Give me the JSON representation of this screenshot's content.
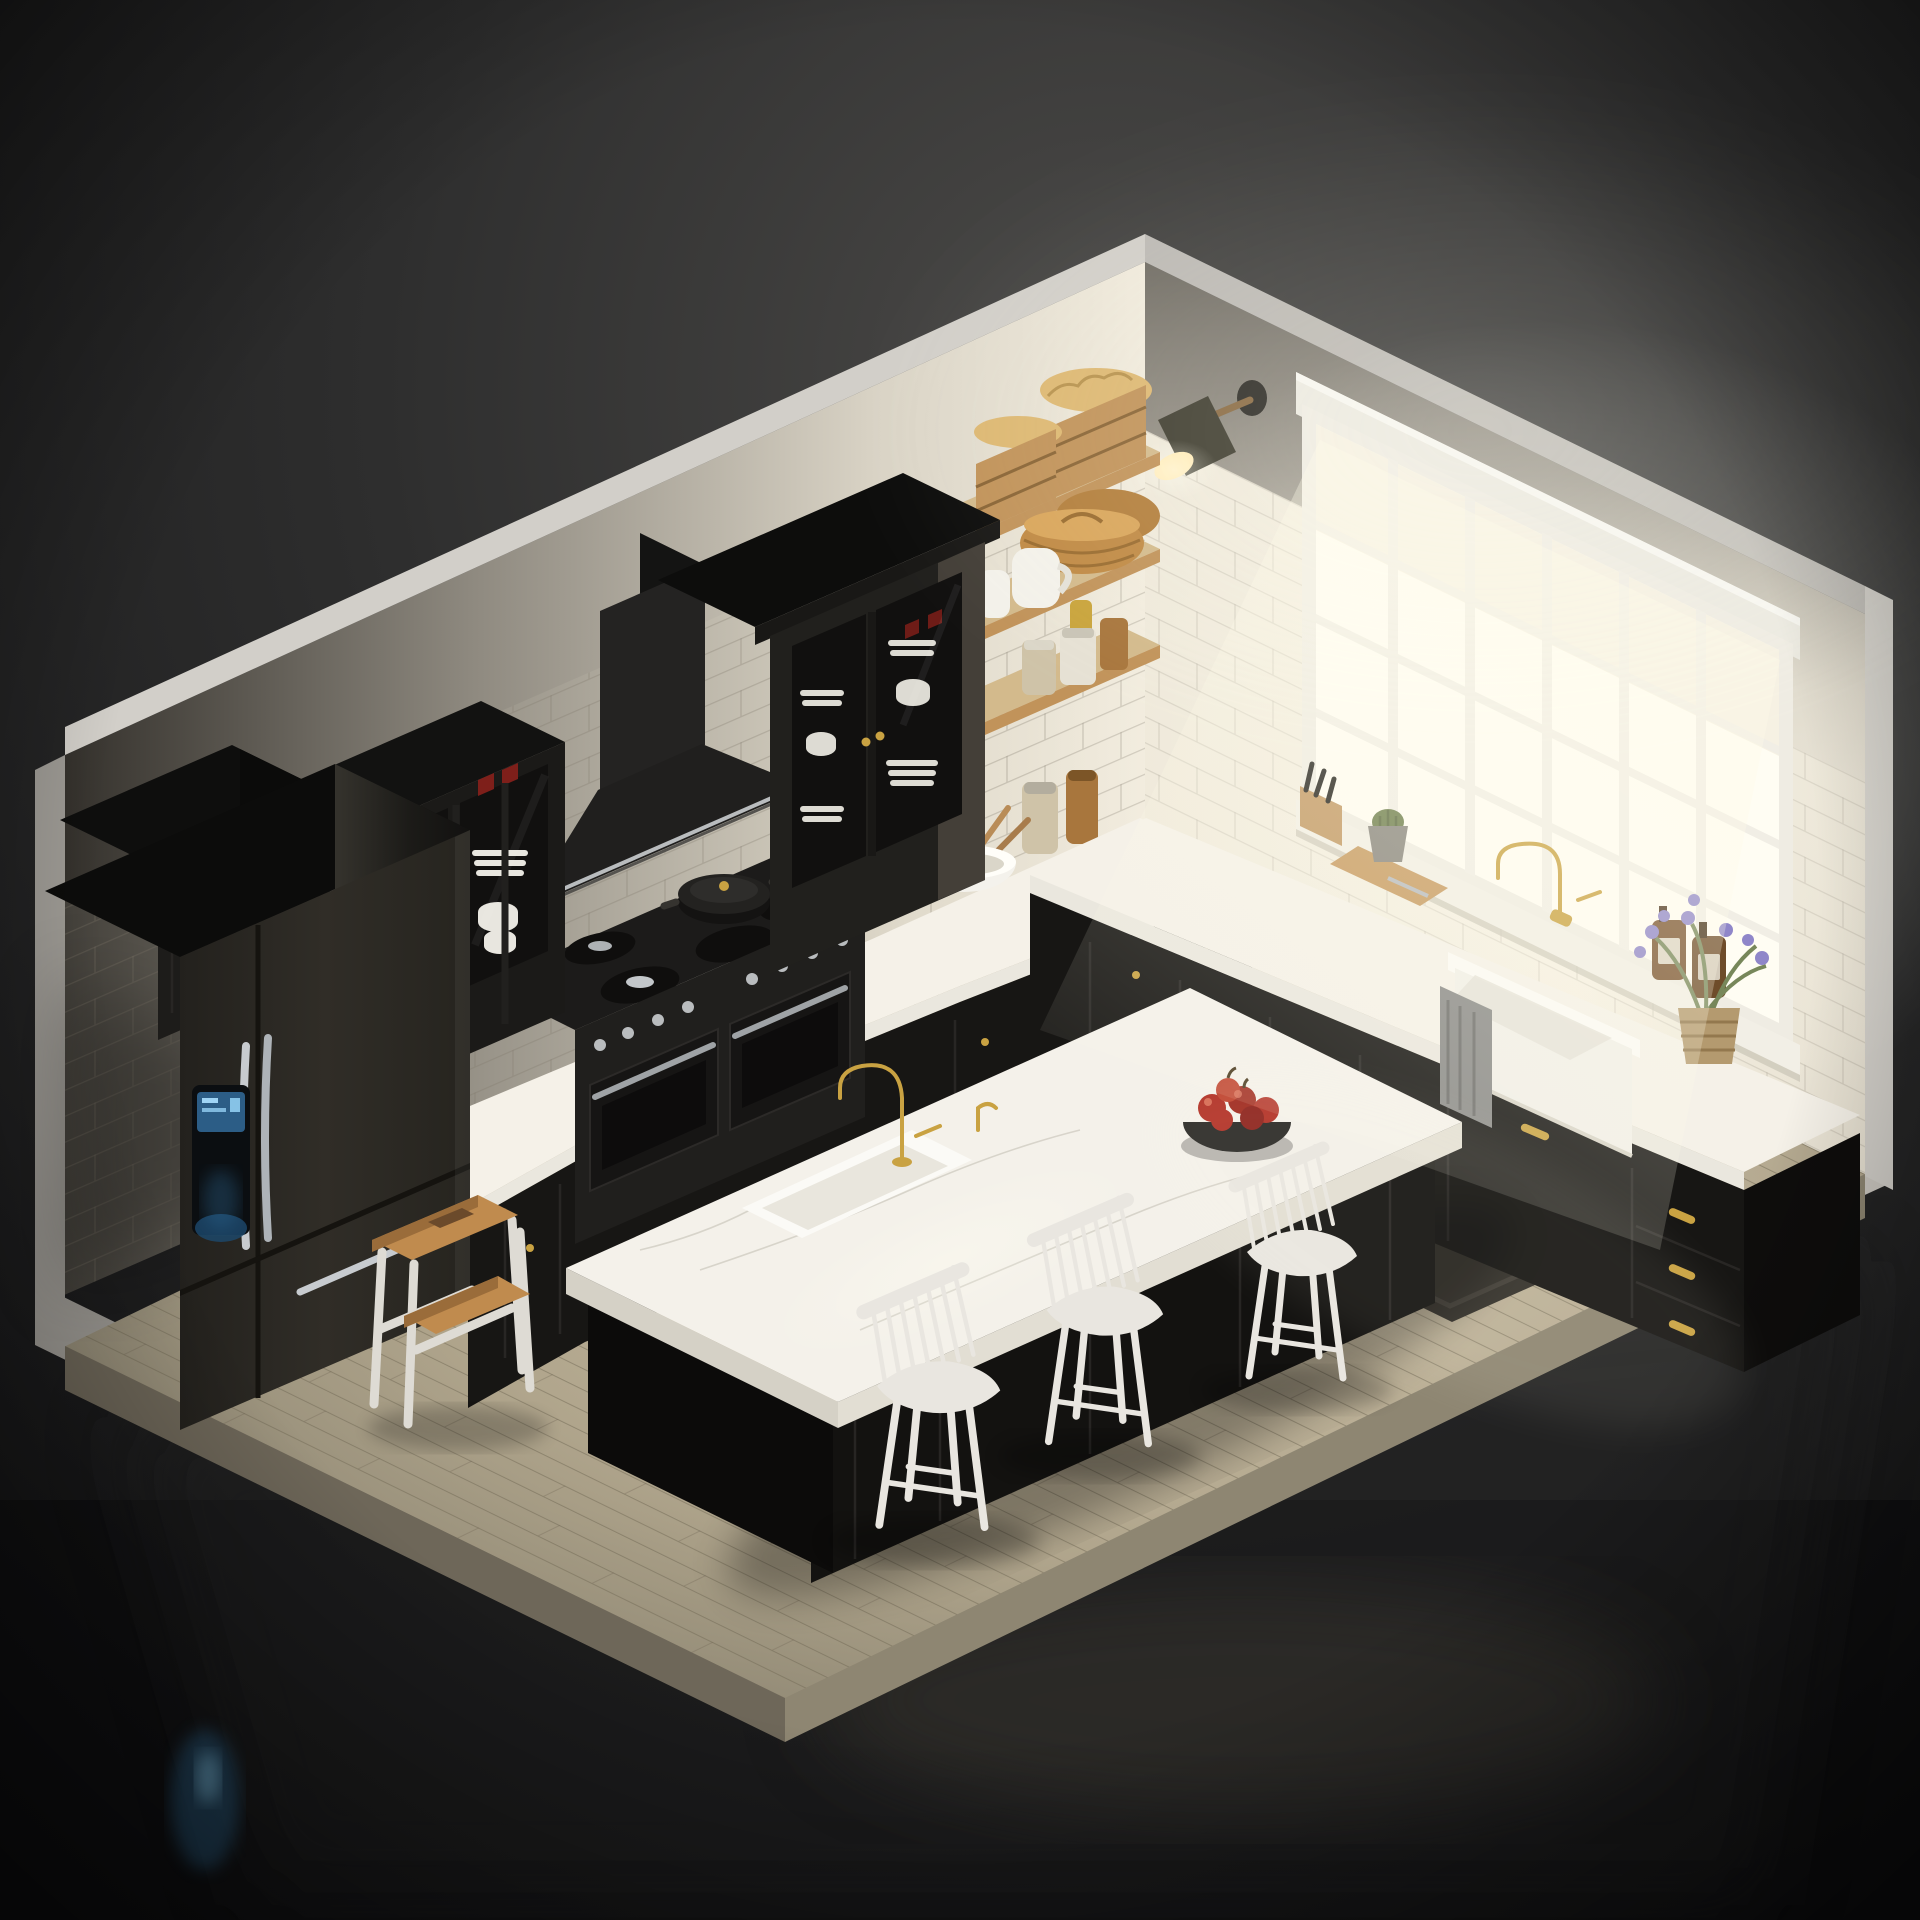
{
  "scene": {
    "description": "Isometric 3D render of a dark farmhouse-style kitchen: black shaker cabinets with brass hardware, white marble countertops, subway-tile walls, a large glowing window, black stainless refrigerator, range with hood, open wood shelves, a marble island with a fruit bowl and three white spindle counter stools, floating on a dark reflective backdrop.",
    "room": {
      "walls": "white subway tile with plaster above, cut-away isometric view",
      "floor": "light oak plank floor on a floating platform",
      "window": {
        "label": "gridded window",
        "grid": "6 columns x 4 rows",
        "shade": "white roller shade, partially lowered"
      },
      "lighting": "strong daylight glow from window, dark vignette around room"
    },
    "objects": [
      {
        "id": "refrigerator",
        "label": "black stainless french-door refrigerator with blue dispenser display"
      },
      {
        "id": "upper-cabinet",
        "label": "black shaker upper cabinet above refrigerator"
      },
      {
        "id": "glass-display-cabinet",
        "label": "black glass-front cabinet with white dishes and red glassware"
      },
      {
        "id": "range-hood",
        "label": "black chimney range hood with chrome trim"
      },
      {
        "id": "gas-range",
        "label": "black double-oven gas range with chrome knobs"
      },
      {
        "id": "dutch-oven",
        "label": "black dutch oven pot with brass knob"
      },
      {
        "id": "kettle",
        "label": "dark stovetop kettle"
      },
      {
        "id": "hutch",
        "label": "black glass hutch with stacked white dinnerware"
      },
      {
        "id": "open-shelves",
        "label": "three oak open shelves"
      },
      {
        "id": "bread-crates",
        "label": "wooden bread crates with loaves"
      },
      {
        "id": "baskets",
        "label": "woven wicker baskets"
      },
      {
        "id": "pitchers",
        "label": "white ceramic pitchers"
      },
      {
        "id": "jars",
        "label": "glass pantry jars and amber spice jars"
      },
      {
        "id": "wall-sconce",
        "label": "olive metal wall sconce, lit"
      },
      {
        "id": "farmhouse-sink",
        "label": "white apron farmhouse sink with gray towel"
      },
      {
        "id": "brass-faucet",
        "label": "brass gooseneck faucet"
      },
      {
        "id": "soap-bottles",
        "label": "amber soap dispenser bottles"
      },
      {
        "id": "knife-block",
        "label": "wood knife block"
      },
      {
        "id": "cutting-board",
        "label": "wood cutting board"
      },
      {
        "id": "cactus",
        "label": "small cactus in gray pot"
      },
      {
        "id": "lavender",
        "label": "lavender flowers in woven pot"
      },
      {
        "id": "mixing-bowl",
        "label": "white bowl with wooden spoons"
      },
      {
        "id": "island",
        "label": "black kitchen island with marble top and prep sink"
      },
      {
        "id": "fruit-bowl",
        "label": "dark bowl of red apples"
      },
      {
        "id": "stools",
        "label": "three white spindle-back counter stools",
        "count": 3
      },
      {
        "id": "step-stool",
        "label": "white and oak two-step stool"
      },
      {
        "id": "rug",
        "label": "dark area rug"
      }
    ]
  },
  "colors": {
    "bg-top": "#4b4a48",
    "bg-edge": "#161617",
    "reflection": "#242425",
    "blue-glow": "#2f6b95",
    "platform-right": "#cbc7c0",
    "platform-left": "#9d9a94",
    "outer-band": "#d2cfc9",
    "wall-dark": "#34312c",
    "wall-mid": "#8f8a80",
    "wall-light": "#d9d3c5",
    "wall-bright": "#f0eadc",
    "wall-top-shadow": "#6e6a62",
    "wood-floor-light": "#cec2a8",
    "wood-floor-dark": "#8a8370",
    "wood-edge": "#8e8672",
    "wood-edge-dark": "#6e6759",
    "cabinet-black": "#171614",
    "cabinet-panel": "#2a2826",
    "cabinet-side": "#0e0d0c",
    "counter-white": "#f5f1e8",
    "counter-edge": "#eae7de",
    "island-top": "#f4f1ea",
    "island-edge": "#e2ded3",
    "vein": "#c9c5ba",
    "brass": "#c9a242",
    "chrome": "#c3c7ca",
    "fridge-body": "#2a2823",
    "fridge-screen": "#2c5d86",
    "window-pane": "#fffdf3",
    "window-frame": "#efece3",
    "shelf-wood": "#d3ba8c",
    "crate-wood": "#c1935a",
    "bread": "#ddb873",
    "basket": "#c08a45",
    "ceramic-white": "#f3f1ea",
    "glass-jar": "#cfc3a8",
    "jar-amber": "#a8763d",
    "pasta-yellow": "#c9a43c",
    "lamp-olive": "#403e31",
    "lamp-light": "#ffe9b0",
    "chair-white": "#e9e6e0",
    "stool-wood": "#c08b4e",
    "stool-frame": "#dedbd4",
    "rug": "#34312b",
    "rug-border": "#45413a",
    "apple-red": "#b23227",
    "bowl-dark": "#2b2a27",
    "plant-green": "#6f7f4e",
    "flower-purple": "#8f86c9",
    "towel-gray": "#8b8b89",
    "pot-gray": "#8b8880"
  }
}
